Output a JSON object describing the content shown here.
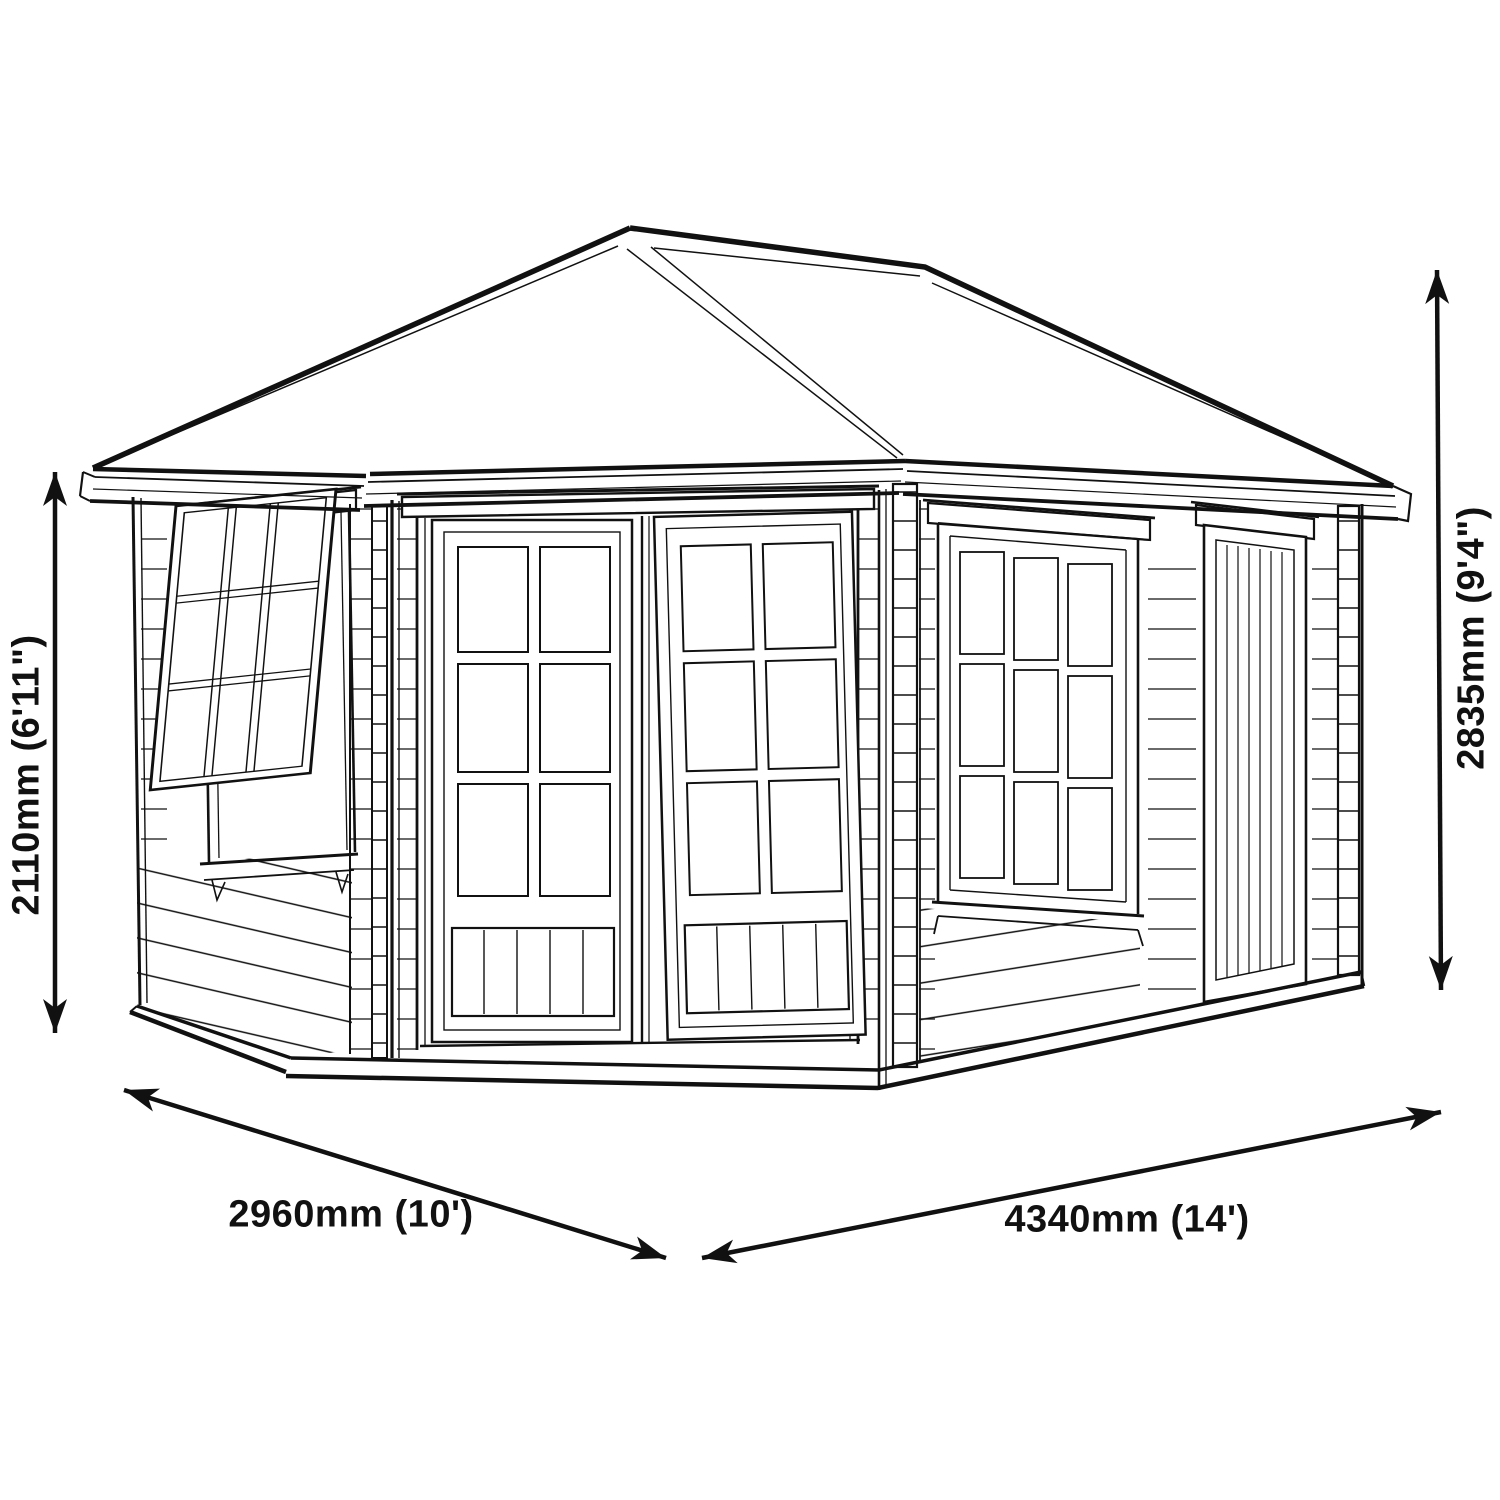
{
  "figure": {
    "background_color": "#ffffff",
    "line_color": "#111111",
    "subject": "corner-summerhouse-dimension-drawing"
  },
  "dimensions": {
    "left_height": "2110mm (6'11\")",
    "right_height": "2835mm (9'4\")",
    "bottom_left_width": "2960mm (10')",
    "bottom_right_width": "4340mm (14')"
  }
}
